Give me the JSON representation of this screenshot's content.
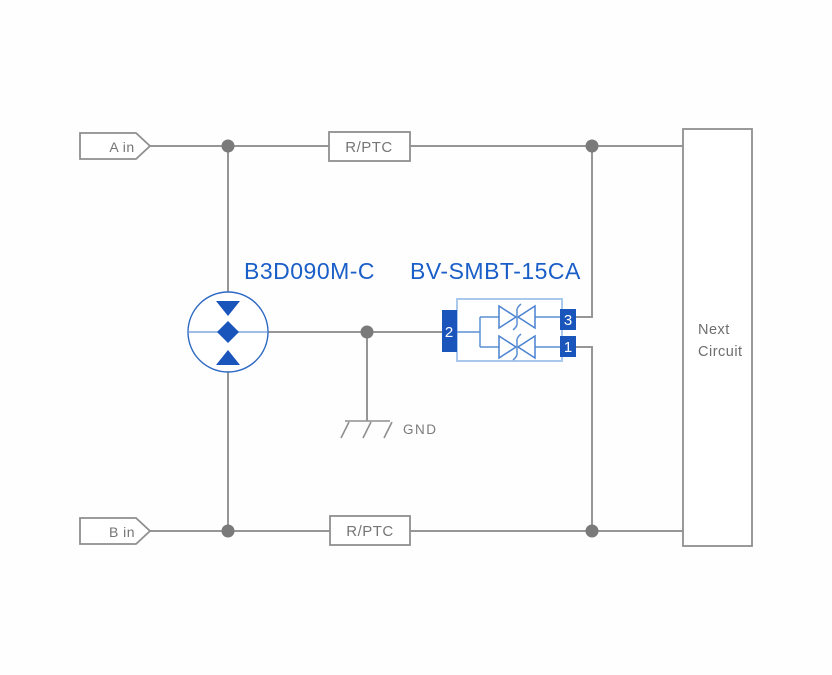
{
  "diagram": {
    "title": "surge-protection-circuit",
    "inputs": {
      "a": "A in",
      "b": "B in"
    },
    "resistors": {
      "top": "R/PTC",
      "bottom": "R/PTC"
    },
    "components": {
      "gas_discharge_tube": {
        "label": "B3D090M-C"
      },
      "tvs_diode": {
        "label": "BV-SMBT-15CA",
        "pins": {
          "pin1": "1",
          "pin2": "2",
          "pin3": "3"
        }
      }
    },
    "ground": {
      "label": "GND"
    },
    "next_circuit": {
      "line1": "Next",
      "line2": "Circuit"
    },
    "colors": {
      "accent_blue": "#1a5ec8",
      "pin_blue": "#1a55bb",
      "body_light_blue": "#a9c9ec",
      "diode_blue": "#4a82d0",
      "tube_ring_blue": "#2e6ac5",
      "wire_gray": "#969696",
      "junction_gray": "#7a7a7a",
      "text_gray": "#757575"
    }
  }
}
